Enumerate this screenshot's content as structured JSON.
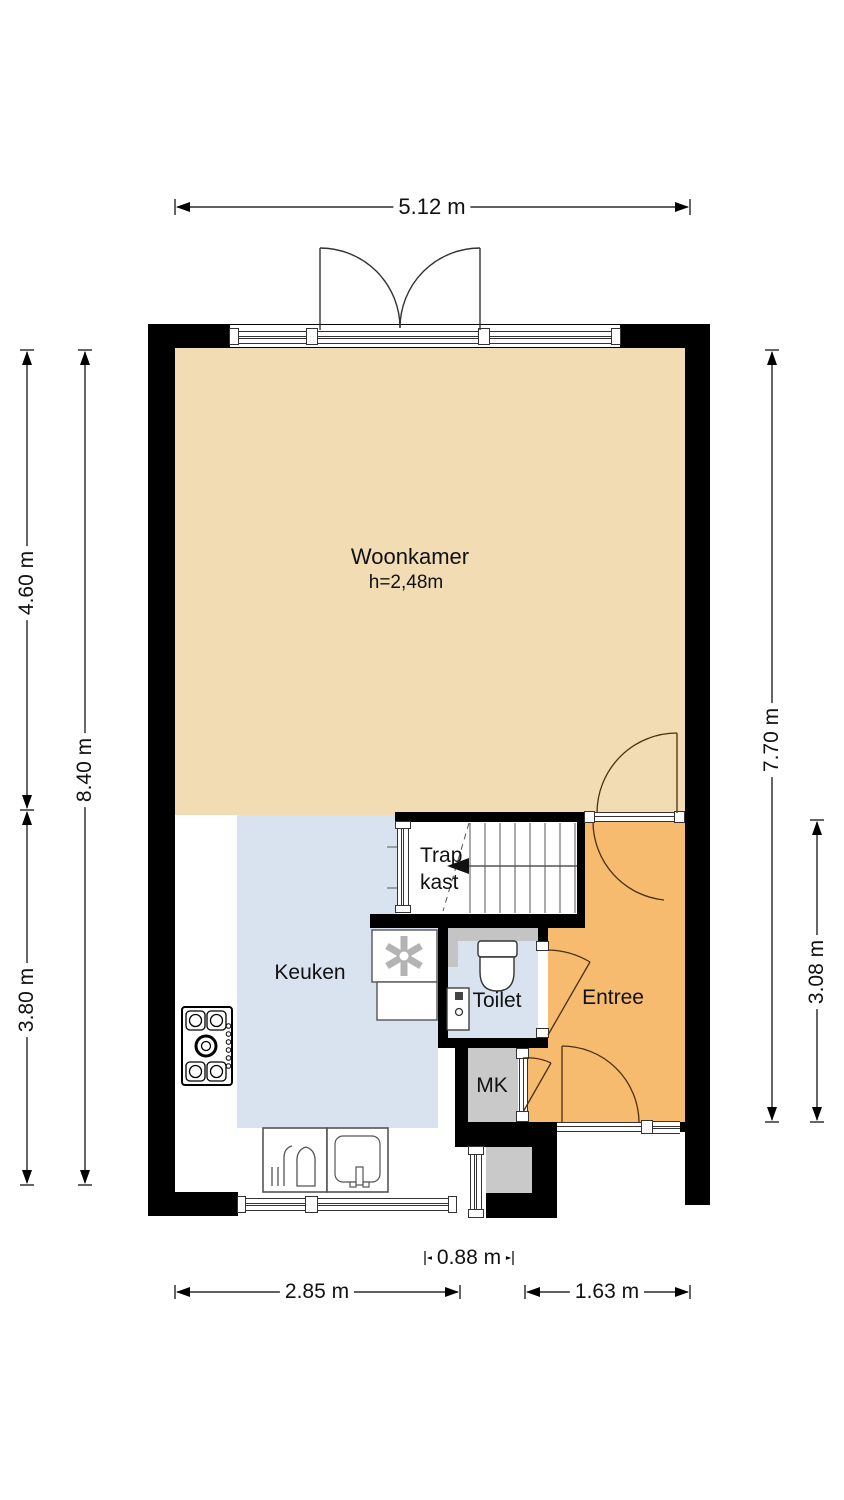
{
  "plan": {
    "type": "floor-plan",
    "rooms": {
      "woonkamer": {
        "label": "Woonkamer",
        "height_note": "h=2,48m"
      },
      "keuken": {
        "label": "Keuken"
      },
      "trapkast": {
        "label": "Trap kast"
      },
      "toilet": {
        "label": "Toilet"
      },
      "entree": {
        "label": "Entree"
      },
      "mk": {
        "label": "MK"
      }
    },
    "dimensions": {
      "top_width": "5.12 m",
      "left_inner_top": "4.60 m",
      "left_inner_bottom": "3.80 m",
      "left_outer": "8.40 m",
      "right_outer": "7.70 m",
      "right_inner": "3.08 m",
      "bottom_entry": "0.88 m",
      "bottom_left": "2.85 m",
      "bottom_right": "1.63 m"
    },
    "icons": [
      "stove-icon",
      "sink-icon",
      "dishwasher-rack-icon",
      "ventilation-fan-icon",
      "toilet-icon",
      "washbasin-icon",
      "stairs-icon",
      "stair-direction-arrow-icon",
      "door-swing-icon",
      "window-icon"
    ],
    "colors": {
      "living_floor": "#f2dcb3",
      "kitchen_floor": "#d9e3ef",
      "hall_floor": "#f6bb6e",
      "closet_floor": "#c9c9c9",
      "wall": "#000000"
    }
  }
}
